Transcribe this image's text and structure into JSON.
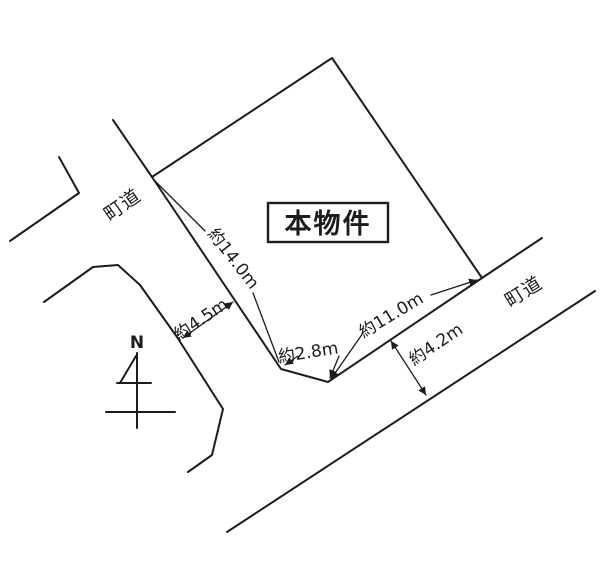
{
  "diagram": {
    "property": {
      "label": "本物件"
    },
    "compass": {
      "label": "N"
    },
    "roads": {
      "left_label": "町道",
      "right_label": "町道"
    },
    "measurements": {
      "northwest_side": "約14.0m",
      "west_road_width": "約4.5m",
      "south_side": "約2.8m",
      "southeast_side": "約11.0m",
      "southeast_road_width": "約4.2m"
    },
    "colors": {
      "line": "#1c1c1c",
      "background": "#ffffff"
    }
  }
}
